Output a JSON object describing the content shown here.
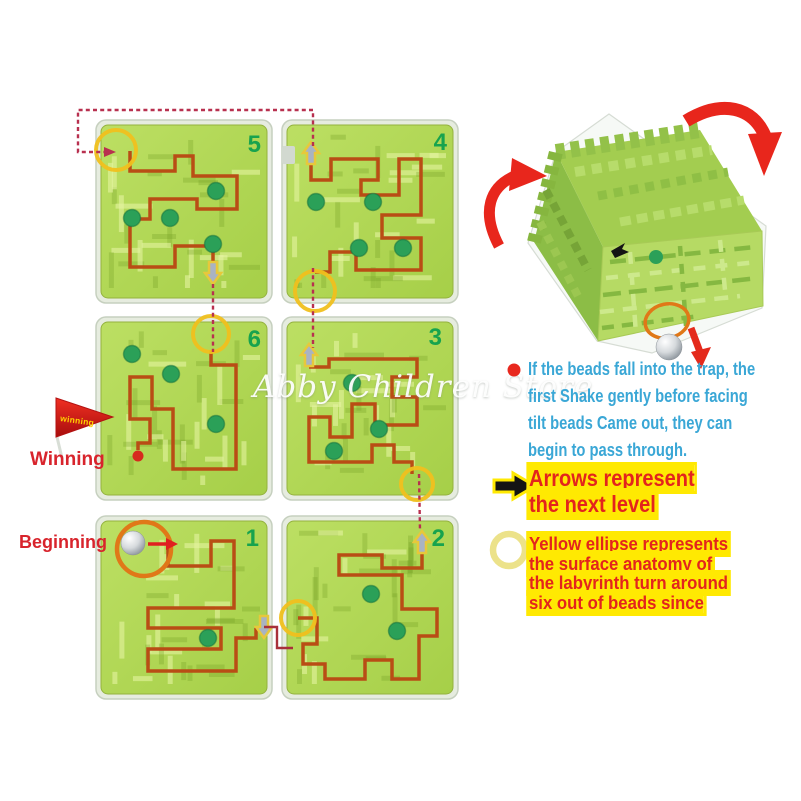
{
  "watermark": "Abby Children Store",
  "labels": {
    "winning": "Winning",
    "beginning": "Beginning",
    "flag": "winning"
  },
  "notes": [
    {
      "name": "trap-note",
      "icon": "red-dot-icon",
      "lines": [
        "If the beads fall into the trap, the",
        "first Shake gently before facing",
        "tilt beads Came out, they can",
        "begin to pass through."
      ]
    },
    {
      "name": "arrows-note",
      "icon": "black-arrow-icon",
      "lines": [
        "Arrows represent",
        "the next level"
      ]
    },
    {
      "name": "ellipse-note",
      "icon": "yellow-ring-icon",
      "lines": [
        "Yellow ellipse represents",
        "the surface anatomy of",
        "the labyrinth turn around",
        "six out of beads since"
      ]
    }
  ],
  "panels": [
    {
      "number": "5",
      "x": 96,
      "y": 120,
      "nx": 165,
      "ny": 32,
      "path": [
        [
          34,
          31
        ],
        [
          34,
          51
        ],
        [
          79,
          51
        ],
        [
          79,
          36
        ],
        [
          97,
          36
        ],
        [
          97,
          56
        ],
        [
          141,
          56
        ],
        [
          141,
          89
        ],
        [
          101,
          89
        ],
        [
          101,
          79
        ],
        [
          54,
          79
        ],
        [
          54,
          99
        ],
        [
          34,
          99
        ],
        [
          34,
          147
        ],
        [
          79,
          147
        ],
        [
          79,
          126
        ],
        [
          117,
          126
        ],
        [
          117,
          143
        ]
      ],
      "dots": [
        [
          120,
          71
        ],
        [
          36,
          98
        ],
        [
          74,
          98
        ],
        [
          117,
          124
        ]
      ],
      "markers": [
        {
          "t": "ring",
          "x": 20,
          "y": 30,
          "r": 20
        },
        {
          "t": "adown",
          "x": 117,
          "y": 153
        }
      ]
    },
    {
      "number": "4",
      "x": 282,
      "y": 120,
      "nx": 165,
      "ny": 30,
      "path": [
        [
          29,
          44
        ],
        [
          29,
          60
        ],
        [
          49,
          60
        ],
        [
          49,
          39
        ],
        [
          96,
          39
        ],
        [
          96,
          60
        ],
        [
          79,
          60
        ],
        [
          79,
          75
        ],
        [
          117,
          75
        ],
        [
          117,
          39
        ],
        [
          139,
          39
        ],
        [
          139,
          95
        ],
        [
          100,
          95
        ],
        [
          100,
          118
        ],
        [
          139,
          118
        ],
        [
          139,
          150
        ],
        [
          74,
          150
        ],
        [
          74,
          132
        ],
        [
          48,
          132
        ],
        [
          48,
          152
        ],
        [
          33,
          152
        ]
      ],
      "dots": [
        [
          34,
          82
        ],
        [
          91,
          82
        ],
        [
          77,
          128
        ],
        [
          121,
          128
        ]
      ],
      "markers": [
        {
          "t": "aup",
          "x": 29,
          "y": 33
        },
        {
          "t": "ring",
          "x": 33,
          "y": 171,
          "r": 20
        },
        {
          "t": "tab",
          "x": 0,
          "y": 26
        }
      ]
    },
    {
      "number": "6",
      "x": 96,
      "y": 317,
      "nx": 165,
      "ny": 30,
      "path": [
        [
          115,
          33
        ],
        [
          115,
          48
        ],
        [
          140,
          48
        ],
        [
          140,
          152
        ],
        [
          77,
          152
        ],
        [
          77,
          92
        ],
        [
          56,
          92
        ],
        [
          56,
          60
        ],
        [
          34,
          60
        ],
        [
          34,
          102
        ],
        [
          54,
          102
        ],
        [
          54,
          126
        ],
        [
          42,
          126
        ],
        [
          42,
          133
        ]
      ],
      "dots": [
        [
          36,
          37
        ],
        [
          75,
          57
        ],
        [
          120,
          107
        ]
      ],
      "markers": [
        {
          "t": "ring",
          "x": 115,
          "y": 17,
          "r": 18
        },
        {
          "t": "enddot",
          "x": 42,
          "y": 139
        }
      ]
    },
    {
      "number": "3",
      "x": 282,
      "y": 317,
      "nx": 160,
      "ny": 28,
      "path": [
        [
          27,
          50
        ],
        [
          47,
          50
        ],
        [
          47,
          42
        ],
        [
          135,
          42
        ],
        [
          135,
          60
        ],
        [
          110,
          60
        ],
        [
          110,
          80
        ],
        [
          135,
          80
        ],
        [
          135,
          108
        ],
        [
          93,
          108
        ],
        [
          93,
          87
        ],
        [
          70,
          87
        ],
        [
          70,
          120
        ],
        [
          48,
          120
        ],
        [
          48,
          100
        ],
        [
          27,
          100
        ],
        [
          27,
          145
        ],
        [
          90,
          145
        ],
        [
          90,
          128
        ],
        [
          112,
          128
        ],
        [
          112,
          145
        ],
        [
          130,
          145
        ],
        [
          130,
          157
        ]
      ],
      "dots": [
        [
          70,
          66
        ],
        [
          97,
          112
        ],
        [
          52,
          134
        ]
      ],
      "markers": [
        {
          "t": "aup",
          "x": 27,
          "y": 38
        },
        {
          "t": "ring",
          "x": 135,
          "y": 167,
          "r": 16
        }
      ]
    },
    {
      "number": "1",
      "x": 96,
      "y": 516,
      "nx": 163,
      "ny": 30,
      "path": [
        [
          72,
          28
        ],
        [
          72,
          50
        ],
        [
          115,
          50
        ],
        [
          115,
          25
        ],
        [
          138,
          25
        ],
        [
          138,
          92
        ],
        [
          52,
          92
        ],
        [
          52,
          112
        ],
        [
          125,
          112
        ],
        [
          125,
          133
        ],
        [
          52,
          133
        ],
        [
          52,
          155
        ],
        [
          140,
          155
        ],
        [
          140,
          122
        ],
        [
          160,
          122
        ],
        [
          160,
          112
        ]
      ],
      "dots": [
        [
          112,
          122
        ]
      ],
      "markers": [
        {
          "t": "oring",
          "x": 48,
          "y": 33,
          "r": 27
        },
        {
          "t": "ball",
          "x": 37,
          "y": 27,
          "r": 12
        },
        {
          "t": "rarrow",
          "x1": 52,
          "y1": 28,
          "x2": 70,
          "y2": 28
        },
        {
          "t": "adown",
          "x": 168,
          "y": 111
        }
      ]
    },
    {
      "number": "2",
      "x": 282,
      "y": 516,
      "nx": 163,
      "ny": 30,
      "path": [
        [
          16,
          102
        ],
        [
          35,
          102
        ],
        [
          35,
          128
        ],
        [
          21,
          128
        ],
        [
          21,
          148
        ],
        [
          43,
          148
        ],
        [
          43,
          163
        ],
        [
          83,
          163
        ],
        [
          83,
          144
        ],
        [
          110,
          144
        ],
        [
          110,
          163
        ],
        [
          137,
          163
        ],
        [
          137,
          120
        ],
        [
          155,
          120
        ],
        [
          155,
          93
        ],
        [
          120,
          93
        ],
        [
          120,
          59
        ],
        [
          57,
          59
        ],
        [
          57,
          39
        ],
        [
          100,
          39
        ],
        [
          100,
          52
        ],
        [
          140,
          52
        ],
        [
          140,
          38
        ]
      ],
      "dots": [
        [
          89,
          78
        ],
        [
          115,
          115
        ]
      ],
      "markers": [
        {
          "t": "ring",
          "x": 16,
          "y": 102,
          "r": 17
        },
        {
          "t": "aup",
          "x": 140,
          "y": 26
        }
      ]
    }
  ],
  "connectors": [
    {
      "style": "dashed",
      "points": [
        [
          313,
          146
        ],
        [
          313,
          110
        ],
        [
          78,
          110
        ],
        [
          78,
          152
        ],
        [
          104,
          152
        ]
      ],
      "head": [
        112,
        152
      ]
    },
    {
      "style": "dashed",
      "points": [
        [
          213,
          284
        ],
        [
          213,
          352
        ]
      ]
    },
    {
      "style": "dashed",
      "points": [
        [
          313,
          268
        ],
        [
          313,
          348
        ]
      ]
    },
    {
      "style": "dashed",
      "points": [
        [
          419,
          474
        ],
        [
          420,
          531
        ]
      ]
    },
    {
      "style": "solid",
      "points": [
        [
          264,
          627
        ],
        [
          277,
          627
        ],
        [
          277,
          648
        ],
        [
          293,
          648
        ]
      ]
    }
  ],
  "colors": {
    "path": "#b94d15",
    "panel_green": "#a6cf48",
    "panel_green_light": "#bcdf63",
    "frame": "#e6ecdf",
    "dot_green": "#2ba058",
    "number_green": "#17a34e",
    "dashed": "#b8304f",
    "accent_red": "#e3241d",
    "highlight_yellow": "#ffe902",
    "note_blue": "#3aa7d6",
    "label_red": "#d8242c",
    "ring_yellow": "#f0c01d",
    "ring_orange": "#e07818",
    "arrow_red": "#e42a1c",
    "cube_green_dark": "#8cbd46",
    "cube_green_mid": "#a3cd50",
    "cube_green_light": "#b6da64"
  }
}
